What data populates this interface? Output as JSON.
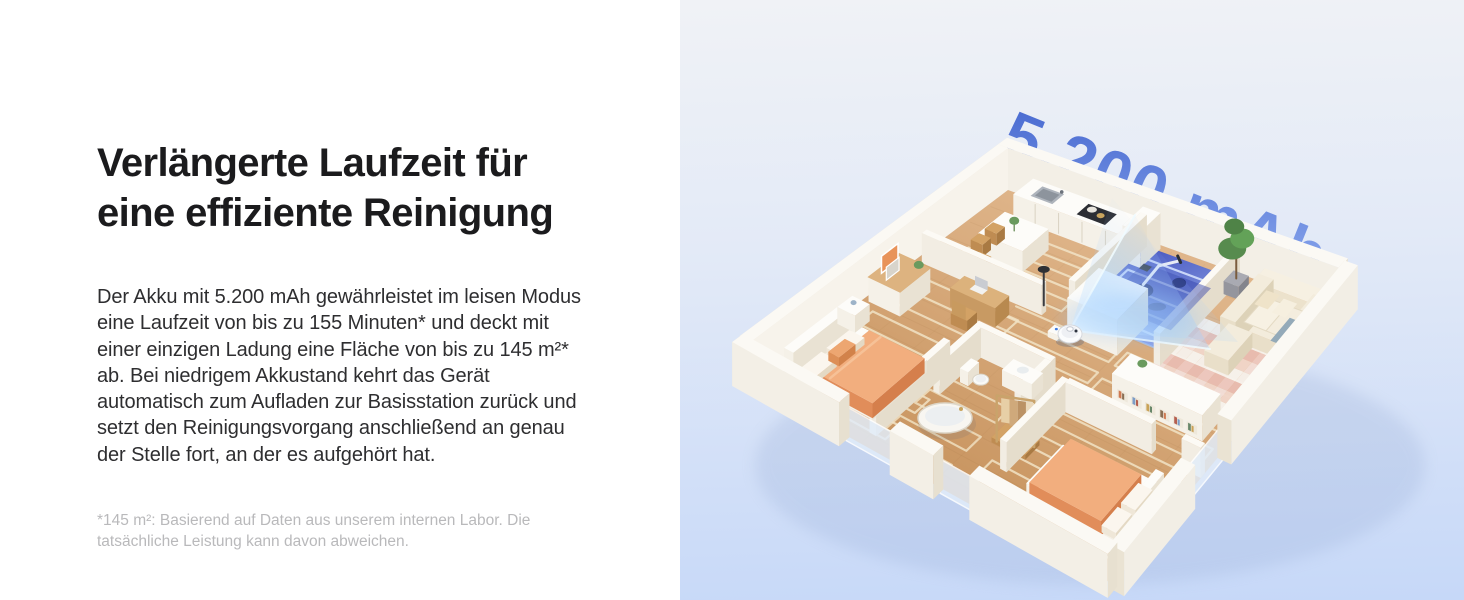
{
  "left_panel": {
    "heading": "Verlängerte Laufzeit für\neine effiziente Reinigung",
    "body": "Der Akku mit 5.200 mAh gewährleistet im leisen Modus\neine Laufzeit von bis zu 155 Minuten* und deckt mit\neiner einzigen Ladung eine Fläche von bis zu 145 m²*\nab. Bei niedrigem Akkustand kehrt das Gerät\nautomatisch zum Aufladen zur Basisstation zurück und\nsetzt den Reinigungsvorgang anschließend an genau\nder Stelle fort, an der es aufgehört hat.",
    "footnote": "*145 m²: Basierend auf Daten aus unserem internen Labor. Die\ntatsächliche Leistung kann davon abweichen."
  },
  "right_panel": {
    "battery_label": "5.200 mAh",
    "illustration": "isometric-apartment-floorplan-with-robot-vacuum-scanning-room",
    "colors": {
      "panel_bg_top": "#f0f2f6",
      "panel_bg_bottom": "#c6d8f8",
      "label_gradient_top": "#4a6bd1",
      "label_gradient_mid": "#7f9de8",
      "label_gradient_bottom": "#d3e3fa",
      "scan_room_dark": "#3d50c5",
      "scan_room_light": "#8ea9ee",
      "beam": "#a8d4ff",
      "floor_wood": "#cf9f6e"
    }
  }
}
